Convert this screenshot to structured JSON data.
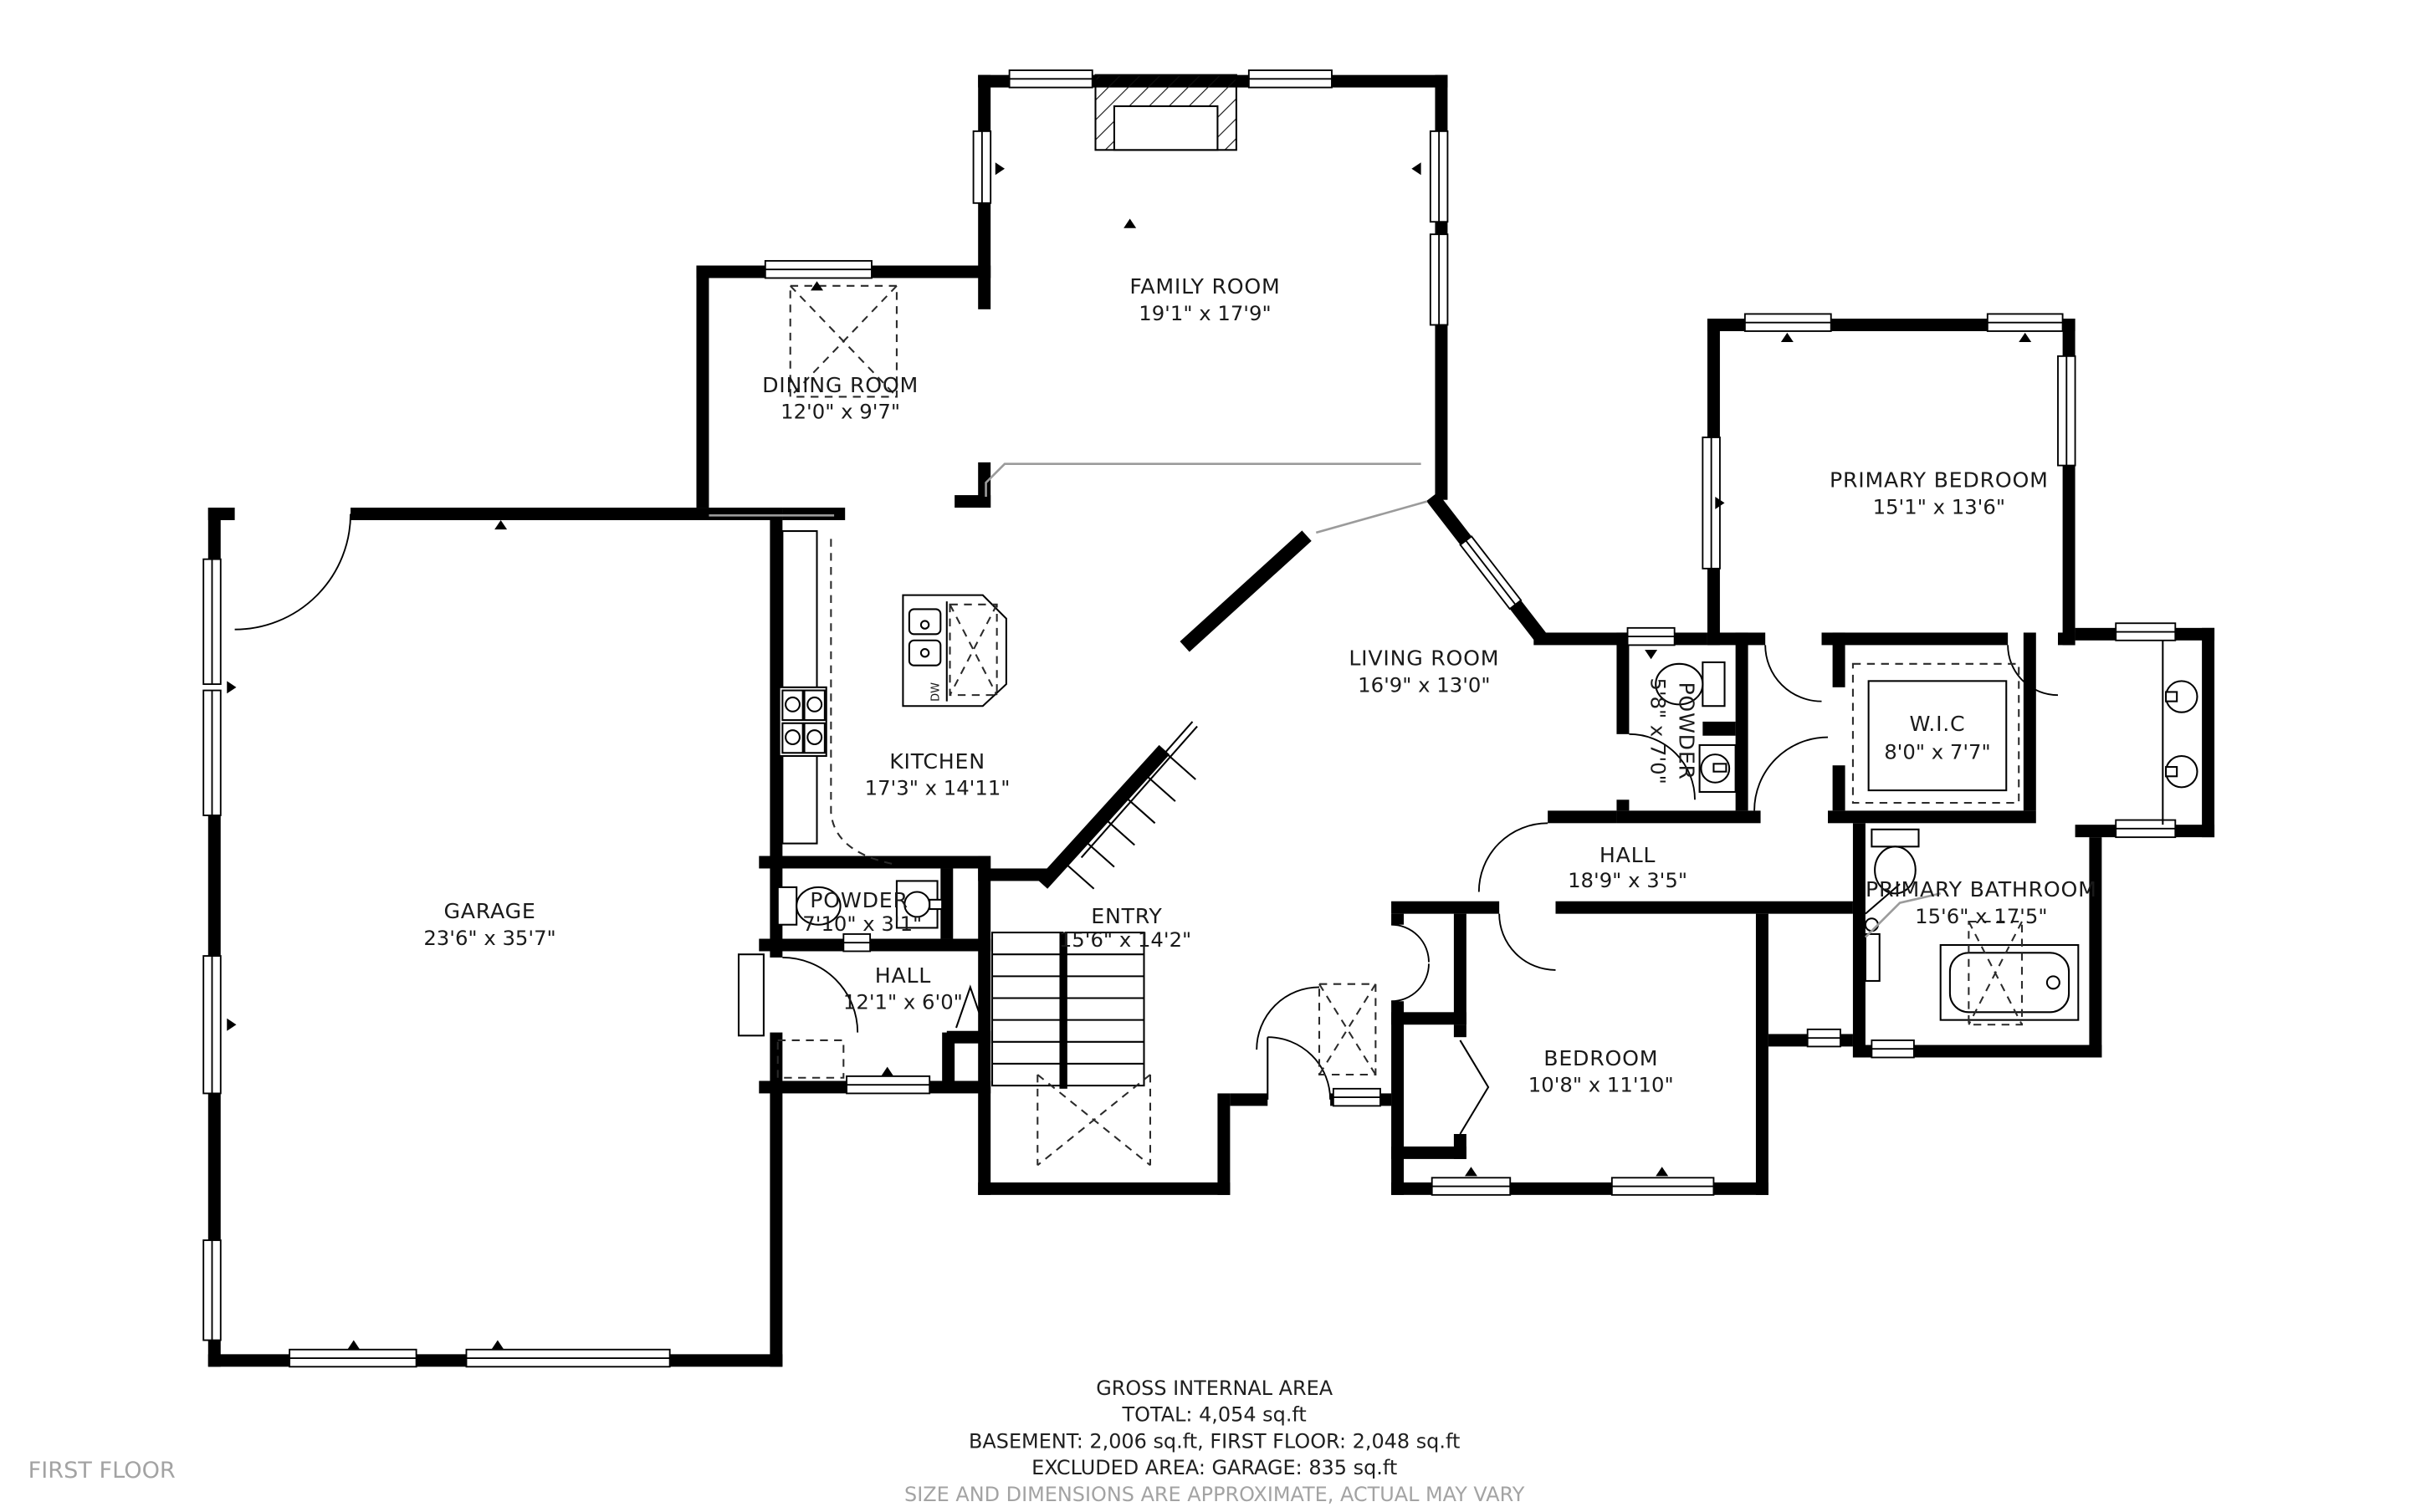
{
  "floor_label": "FIRST FLOOR",
  "rooms": {
    "family_room": {
      "name": "FAMILY ROOM",
      "dims": "19'1\" x 17'9\""
    },
    "dining_room": {
      "name": "DINING ROOM",
      "dims": "12'0\" x 9'7\""
    },
    "primary_bedroom": {
      "name": "PRIMARY BEDROOM",
      "dims": "15'1\" x 13'6\""
    },
    "living_room": {
      "name": "LIVING ROOM",
      "dims": "16'9\" x 13'0\""
    },
    "kitchen": {
      "name": "KITCHEN",
      "dims": "17'3\" x 14'11\""
    },
    "powder_upper": {
      "name": "POWDER",
      "dims": "5'8\" x 7'0\""
    },
    "wic": {
      "name": "W.I.C",
      "dims": "8'0\" x 7'7\""
    },
    "garage": {
      "name": "GARAGE",
      "dims": "23'6\" x 35'7\""
    },
    "powder_lower": {
      "name": "POWDER",
      "dims": "7'10\" x 3'1\""
    },
    "hall_small": {
      "name": "HALL",
      "dims": "12'1\" x 6'0\""
    },
    "entry": {
      "name": "ENTRY",
      "dims": "15'6\" x 14'2\""
    },
    "hall_long": {
      "name": "HALL",
      "dims": "18'9\" x 3'5\""
    },
    "primary_bathroom": {
      "name": "PRIMARY BATHROOM",
      "dims": "15'6\" x 17'5\""
    },
    "bedroom": {
      "name": "BEDROOM",
      "dims": "10'8\" x 11'10\""
    }
  },
  "appliances": {
    "dishwasher": "DW"
  },
  "footer": {
    "title": "GROSS INTERNAL AREA",
    "total": "TOTAL: 4,054 sq.ft",
    "floors": "BASEMENT: 2,006 sq.ft, FIRST FLOOR: 2,048 sq.ft",
    "excluded": "EXCLUDED AREA: GARAGE: 835 sq.ft",
    "disclaimer": "SIZE AND DIMENSIONS ARE APPROXIMATE, ACTUAL MAY VARY"
  },
  "colors": {
    "wall": "#000000",
    "text": "#1a1a1a",
    "muted": "#a3a3a3"
  }
}
